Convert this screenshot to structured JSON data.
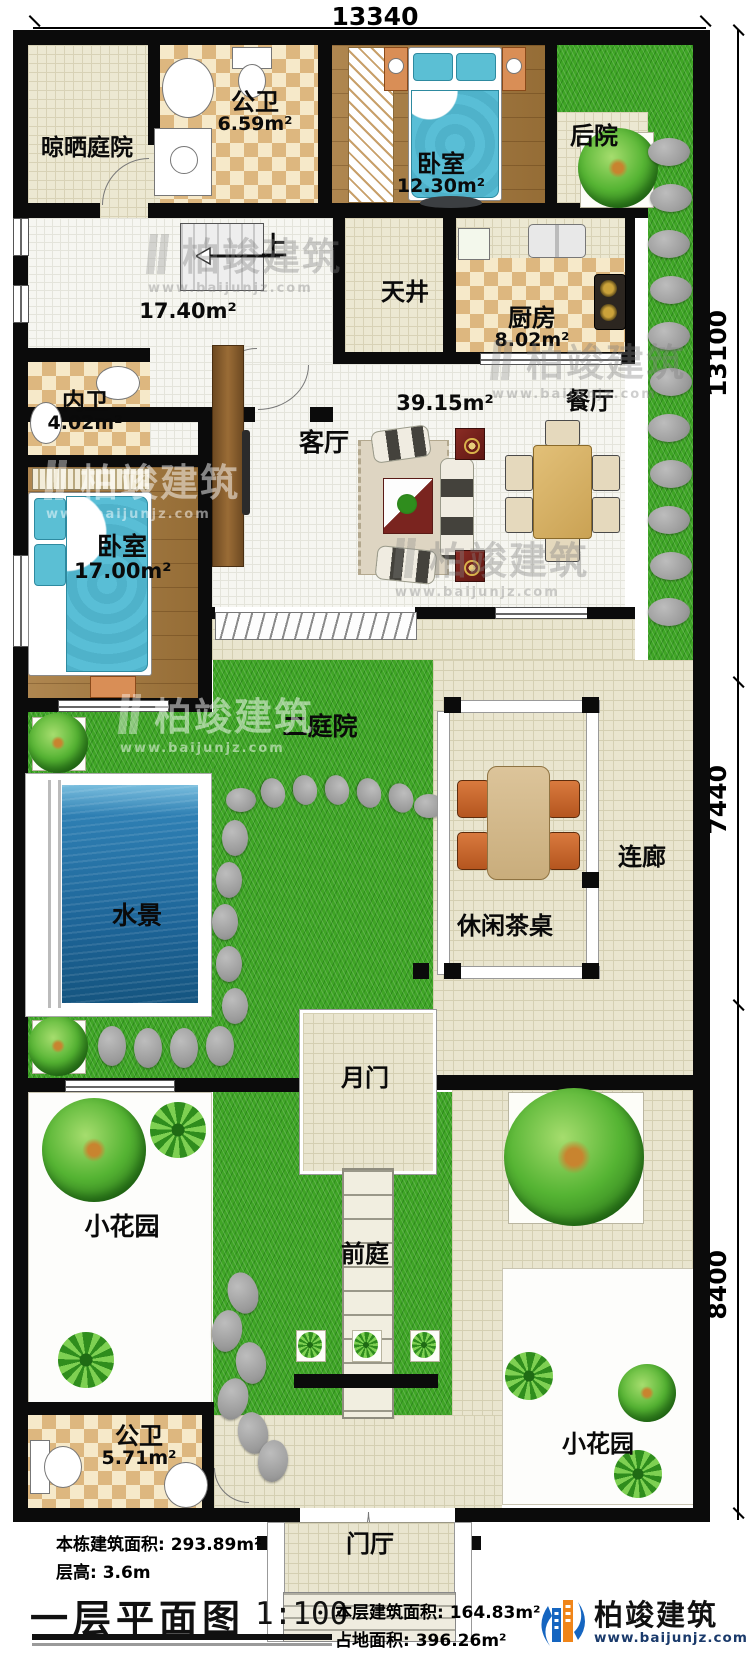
{
  "dimensions": {
    "top": "13340",
    "right": [
      "13100",
      "7440",
      "8400"
    ]
  },
  "rooms": {
    "drying_yard": {
      "name": "晾晒庭院"
    },
    "public_bath_1": {
      "name": "公卫",
      "area": "6.59m²"
    },
    "bedroom_1": {
      "name": "卧室",
      "area": "12.30m²"
    },
    "back_yard": {
      "name": "后院"
    },
    "stair_hall": {
      "up": "上",
      "area": "17.40m²"
    },
    "patio": {
      "name": "天井"
    },
    "kitchen": {
      "name": "厨房",
      "area": "8.02m²"
    },
    "inner_bath": {
      "name": "内卫",
      "area": "4.02m²"
    },
    "living": {
      "name": "客厅",
      "area": "39.15m²"
    },
    "dining": {
      "name": "餐厅"
    },
    "bedroom_2": {
      "name": "卧室",
      "area": "17.00m²"
    },
    "courtyard_2": {
      "name": "二庭院"
    },
    "water_feature": {
      "name": "水景"
    },
    "tea_table": {
      "name": "休闲茶桌"
    },
    "corridor": {
      "name": "连廊"
    },
    "moon_gate": {
      "name": "月门"
    },
    "garden_left": {
      "name": "小花园"
    },
    "front_yard": {
      "name": "前庭"
    },
    "garden_right": {
      "name": "小花园"
    },
    "public_bath_2": {
      "name": "公卫",
      "area": "5.71m²"
    },
    "entry_hall": {
      "name": "门厅"
    }
  },
  "title_block": {
    "building_area": "本栋建筑面积: 293.89m²",
    "floor_height": "层高: 3.6m",
    "title": "一层平面图",
    "scale": "1:100",
    "floor_area": "本层建筑面积: 164.83m²",
    "land_area": "占地面积: 396.26m²"
  },
  "logo": {
    "name": "柏竣建筑",
    "url": "www.baijunjz.com"
  },
  "watermark": {
    "text": "柏竣建筑",
    "url": "www.baijunjz.com"
  }
}
